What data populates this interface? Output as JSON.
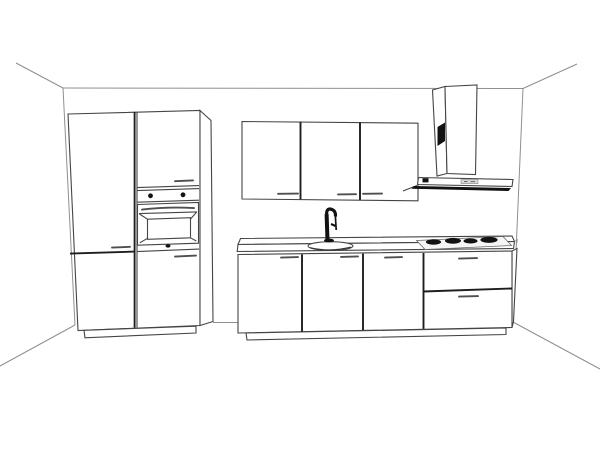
{
  "scene": {
    "background_color": "#ffffff",
    "wall_line_color": "#8f8f8f",
    "outline_color": "#454545",
    "divider_color": "#1e1e1e",
    "handle_color": "#4f4f4f",
    "appliance_dark_color": "#121212",
    "panel_gray_color": "#d8d8d8"
  },
  "components": {
    "room": {
      "label": "room perspective outline"
    },
    "tall_cabinet": {
      "label": "tall cabinet with built-in oven",
      "door_count": 4,
      "handle_count": 3
    },
    "oven": {
      "label": "built-in oven",
      "knob_count": 2
    },
    "wall_cabinets": {
      "label": "wall cabinets",
      "door_count": 3,
      "handle_count": 3
    },
    "hood": {
      "label": "chimney extractor hood"
    },
    "base_run": {
      "label": "base cabinet run",
      "door_count": 3,
      "drawer_count": 2,
      "handle_count": 5
    },
    "countertop": {
      "label": "countertop"
    },
    "sink": {
      "label": "inset sink"
    },
    "faucet": {
      "label": "kitchen faucet"
    },
    "cooktop": {
      "label": "cooktop",
      "burner_count": 4
    }
  }
}
